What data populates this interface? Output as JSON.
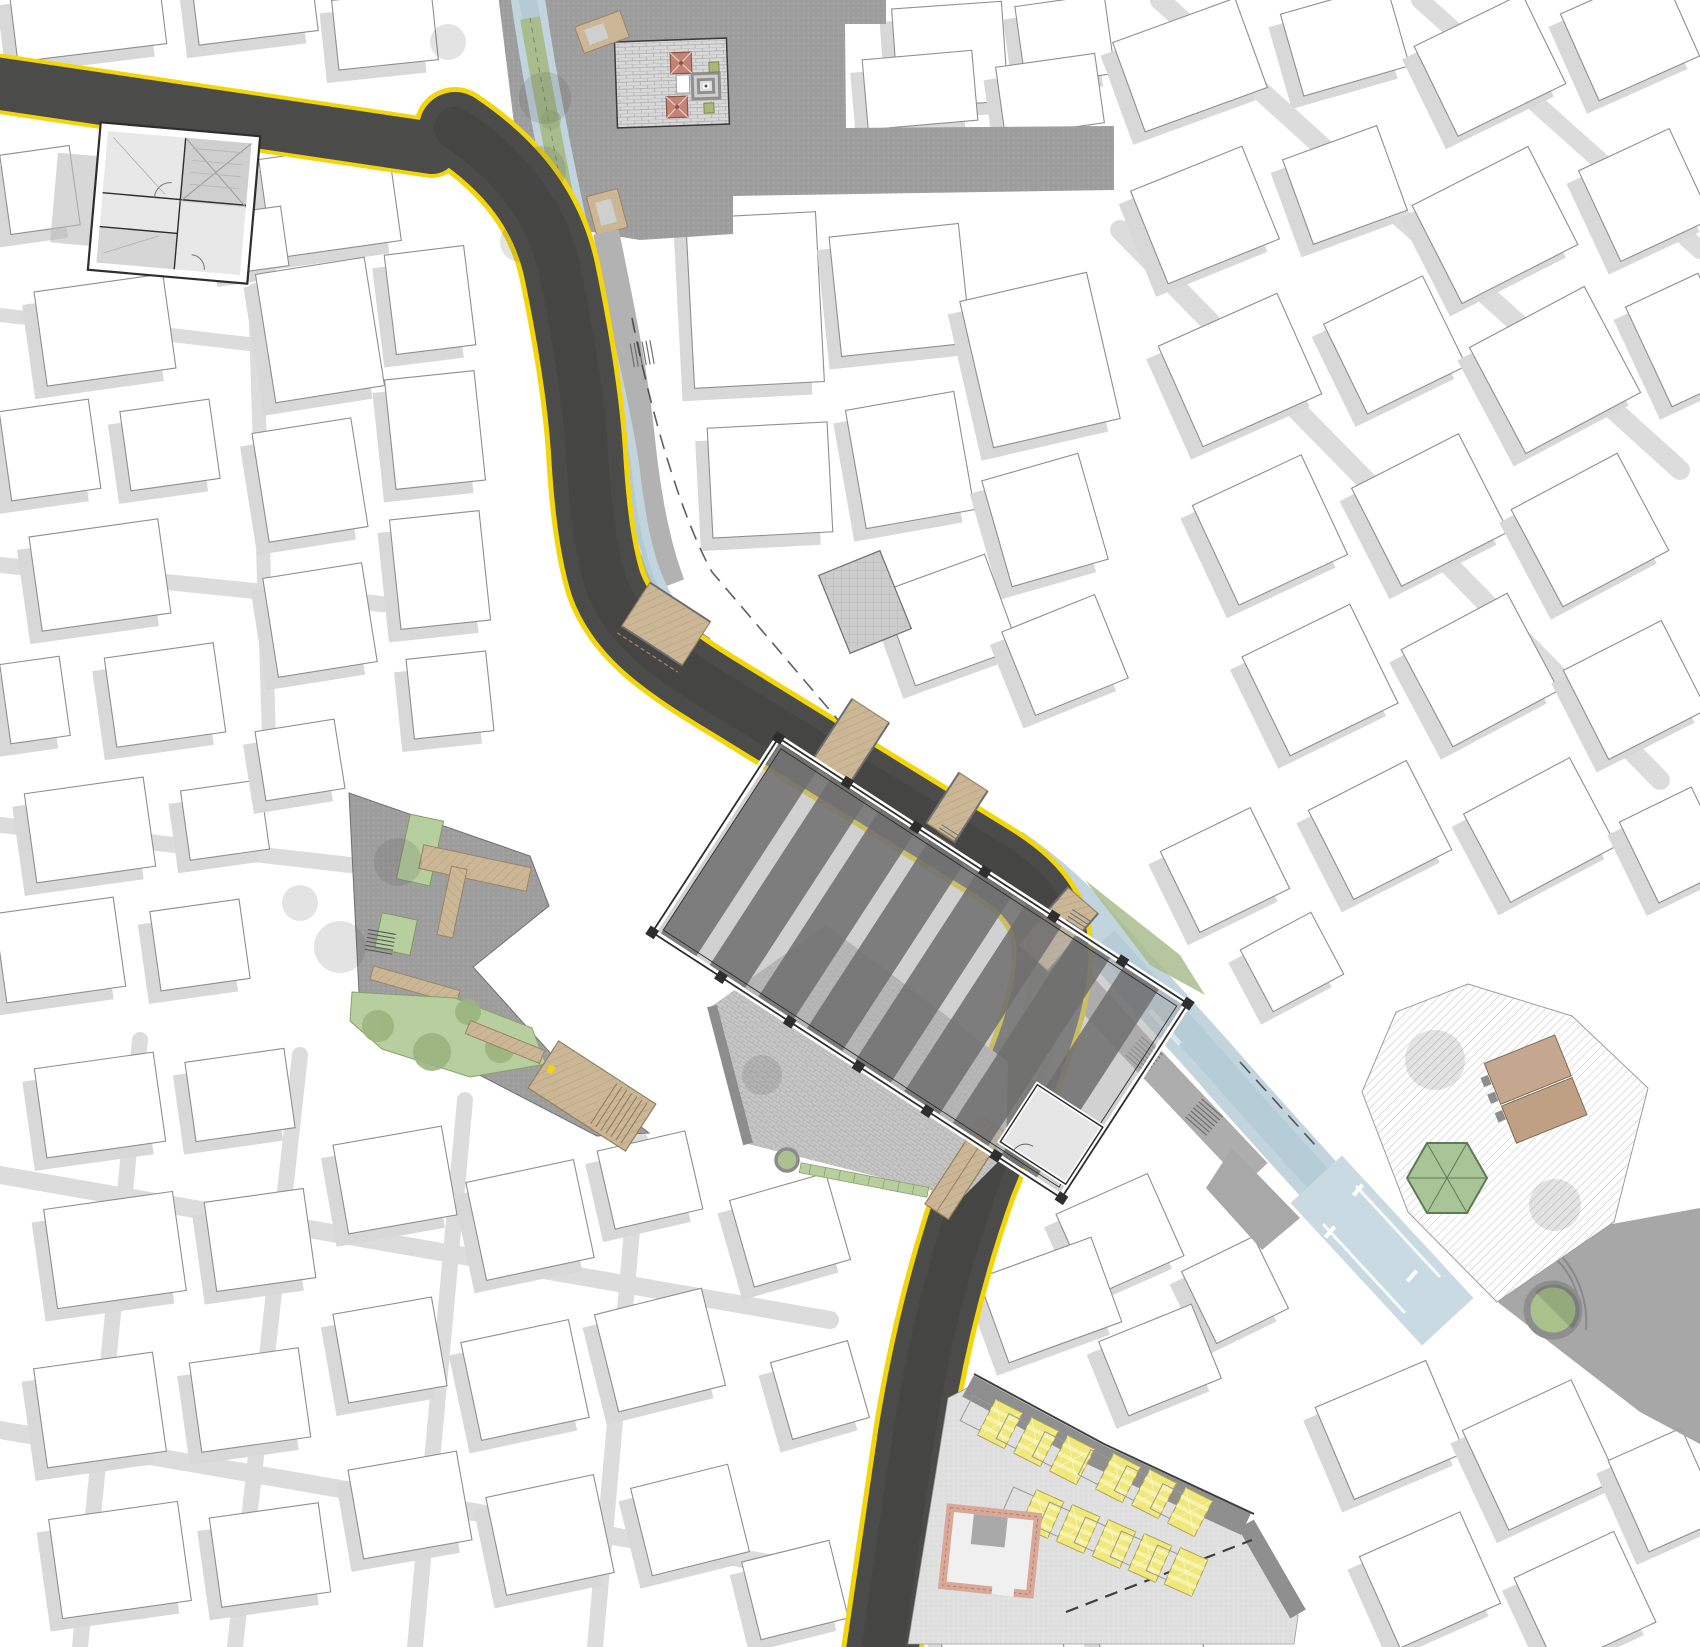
{
  "map": {
    "document_type": "architectural-site-plan",
    "orientation": "plan-view",
    "colors": {
      "background": "#ffffff",
      "building_fill": "#ffffff",
      "building_stroke": "#8f8f8f",
      "shadow": "#d8d8d8",
      "street": "#dcdcdc",
      "asphalt": "#4b4b49",
      "asphalt_dark": "#3f3f3e",
      "road_marking_yellow": "#f2d60a",
      "canal_water": "#c2d4de",
      "canal_deep": "#a9c3d0",
      "greenway": "#a9bc8d",
      "greenway_line": "#6d7c57",
      "lawn": "#b7cf9e",
      "foliage": "#93ac74",
      "tree_shadow": "rgba(80,80,80,0.16)",
      "timber": "#cbb795",
      "timber_edge": "#9b8466",
      "paving_dark": "#9e9e9e",
      "paving_light": "#e0e0e0",
      "cobble_base": "#c6c6c6",
      "brick_paving": "#d9d9d9",
      "hatch_line": "#b8b8b8",
      "stall_yellow": "#f0e87d",
      "stall_stripe": "#f8f3ab",
      "stall_edge": "#ada64f",
      "canopy_red": "#c38476",
      "canopy_red_edge": "#8d574c",
      "hexagon_green": "#a9c598",
      "hexagon_edge": "#5d7c55",
      "tan_building": "#c4a78e",
      "tan_building_edge": "#7d6a55",
      "brick_wall": "#d9a896",
      "brick_wall_dark": "#b07f6e",
      "hall_roof": "#6e6e6e",
      "hall_gap": "#ababab",
      "wall_line": "#2e2e2e",
      "stair_line": "#6f6f6f",
      "dash_line": "#2b2b2b"
    },
    "features": {
      "main_street": "curving asphalt street with yellow edge lines",
      "stream": "daylighted stream channel running beside the street into a plaza basin",
      "market_hall": "long open-air hall with striped roof bays and perimeter columns",
      "pocket_park": "triangular park with lawns, timber decks and stairs",
      "upper_plaza": "brick-paved court with fountain, two red canopies and benches",
      "east_plaza": "hatch-paved plaza with green hexagonal pavilion and round tree planter",
      "market_plaza": "light paved ground with two rows of yellow canopy stalls",
      "bridges": "timber decks crossing the stream"
    },
    "counts": {
      "red_canopies": 2,
      "yellow_market_stalls": 11,
      "timber_bridges": 4,
      "stair_flights": 5,
      "round_tree_planters": 2,
      "hexagon_pavilions": 1
    },
    "context_buildings": [
      [
        88,
        18,
        150,
        70,
        -7
      ],
      [
        255,
        8,
        120,
        60,
        -7
      ],
      [
        385,
        30,
        100,
        70,
        -6
      ],
      [
        950,
        55,
        110,
        100,
        -4
      ],
      [
        1065,
        40,
        90,
        80,
        -8
      ],
      [
        40,
        190,
        70,
        80,
        -8
      ],
      [
        330,
        200,
        130,
        100,
        -8
      ],
      [
        255,
        240,
        60,
        60,
        -8
      ],
      [
        105,
        330,
        130,
        95,
        -8
      ],
      [
        50,
        450,
        90,
        90,
        -8
      ],
      [
        170,
        445,
        90,
        80,
        -8
      ],
      [
        100,
        575,
        130,
        95,
        -8
      ],
      [
        35,
        700,
        60,
        80,
        -8
      ],
      [
        165,
        695,
        110,
        90,
        -8
      ],
      [
        90,
        830,
        120,
        90,
        -8
      ],
      [
        225,
        820,
        80,
        70,
        -8
      ],
      [
        60,
        950,
        120,
        90,
        -8
      ],
      [
        200,
        945,
        90,
        80,
        -8
      ],
      [
        320,
        330,
        110,
        130,
        -9
      ],
      [
        310,
        480,
        100,
        110,
        -9
      ],
      [
        320,
        620,
        100,
        100,
        -9
      ],
      [
        300,
        760,
        80,
        70,
        -9
      ],
      [
        430,
        300,
        80,
        100,
        -7
      ],
      [
        435,
        430,
        90,
        110,
        -6
      ],
      [
        440,
        570,
        90,
        110,
        -6
      ],
      [
        450,
        695,
        80,
        80,
        -6
      ],
      [
        780,
        80,
        120,
        80,
        -3
      ],
      [
        920,
        90,
        110,
        70,
        -5
      ],
      [
        1050,
        95,
        100,
        70,
        -8
      ],
      [
        755,
        300,
        130,
        170,
        -3
      ],
      [
        900,
        290,
        130,
        120,
        -6
      ],
      [
        1040,
        360,
        130,
        150,
        -13
      ],
      [
        770,
        480,
        120,
        110,
        -3
      ],
      [
        910,
        460,
        110,
        120,
        -10
      ],
      [
        1045,
        520,
        100,
        110,
        -16
      ],
      [
        950,
        620,
        110,
        100,
        -20
      ],
      [
        1065,
        655,
        100,
        90,
        -22
      ],
      [
        1190,
        65,
        130,
        95,
        -20
      ],
      [
        1345,
        40,
        110,
        85,
        -16
      ],
      [
        1490,
        65,
        120,
        100,
        -26
      ],
      [
        1630,
        35,
        110,
        95,
        -24
      ],
      [
        1205,
        215,
        120,
        100,
        -22
      ],
      [
        1345,
        185,
        100,
        90,
        -20
      ],
      [
        1495,
        225,
        130,
        110,
        -27
      ],
      [
        1645,
        195,
        100,
        100,
        -25
      ],
      [
        1240,
        370,
        130,
        110,
        -24
      ],
      [
        1395,
        345,
        110,
        100,
        -26
      ],
      [
        1555,
        370,
        130,
        120,
        -28
      ],
      [
        1685,
        340,
        80,
        110,
        -25
      ],
      [
        1270,
        530,
        120,
        110,
        -25
      ],
      [
        1430,
        510,
        120,
        110,
        -27
      ],
      [
        1590,
        530,
        120,
        110,
        -28
      ],
      [
        1320,
        680,
        120,
        110,
        -26
      ],
      [
        1480,
        670,
        120,
        110,
        -28
      ],
      [
        1635,
        690,
        110,
        100,
        -27
      ],
      [
        1380,
        830,
        110,
        100,
        -27
      ],
      [
        1540,
        830,
        120,
        100,
        -28
      ],
      [
        1675,
        845,
        80,
        90,
        -26
      ],
      [
        1225,
        870,
        100,
        90,
        -26
      ],
      [
        1292,
        962,
        80,
        70,
        -28
      ],
      [
        1120,
        1235,
        100,
        90,
        -24
      ],
      [
        1235,
        1290,
        80,
        80,
        -26
      ],
      [
        1390,
        1430,
        120,
        100,
        -23
      ],
      [
        1540,
        1455,
        120,
        110,
        -25
      ],
      [
        1665,
        1490,
        80,
        100,
        -24
      ],
      [
        1430,
        1580,
        110,
        100,
        -24
      ],
      [
        1585,
        1600,
        110,
        100,
        -25
      ],
      [
        100,
        1105,
        120,
        90,
        -8
      ],
      [
        240,
        1095,
        100,
        80,
        -8
      ],
      [
        115,
        1250,
        130,
        100,
        -8
      ],
      [
        260,
        1240,
        100,
        90,
        -8
      ],
      [
        395,
        1180,
        110,
        90,
        -10
      ],
      [
        530,
        1220,
        110,
        100,
        -12
      ],
      [
        650,
        1180,
        90,
        80,
        -13
      ],
      [
        100,
        1410,
        120,
        100,
        -8
      ],
      [
        250,
        1400,
        110,
        90,
        -8
      ],
      [
        390,
        1350,
        100,
        90,
        -10
      ],
      [
        525,
        1380,
        110,
        100,
        -12
      ],
      [
        660,
        1350,
        110,
        100,
        -14
      ],
      [
        120,
        1560,
        130,
        100,
        -8
      ],
      [
        270,
        1555,
        110,
        90,
        -8
      ],
      [
        410,
        1505,
        110,
        90,
        -10
      ],
      [
        550,
        1535,
        110,
        100,
        -12
      ],
      [
        690,
        1520,
        100,
        90,
        -14
      ],
      [
        790,
        1230,
        100,
        90,
        -16
      ],
      [
        820,
        1390,
        80,
        80,
        -16
      ],
      [
        795,
        1590,
        90,
        80,
        -14
      ],
      [
        1050,
        1300,
        120,
        90,
        -20
      ],
      [
        1160,
        1360,
        100,
        80,
        -22
      ],
      [
        1000,
        1630,
        120,
        60,
        -10
      ],
      [
        1150,
        1640,
        100,
        50,
        -15
      ]
    ],
    "street_strips": [
      [
        140,
        1040,
        80,
        1647,
        16
      ],
      [
        300,
        1055,
        235,
        1647,
        16
      ],
      [
        465,
        1100,
        415,
        1647,
        16
      ],
      [
        640,
        1140,
        595,
        1647,
        16
      ],
      [
        0,
        1175,
        830,
        1320,
        18
      ],
      [
        0,
        1430,
        780,
        1565,
        18
      ],
      [
        1160,
        0,
        1680,
        470,
        20
      ],
      [
        1420,
        0,
        1700,
        250,
        18
      ],
      [
        1120,
        230,
        1660,
        780,
        20
      ],
      [
        255,
        290,
        270,
        770,
        14
      ],
      [
        0,
        315,
        300,
        350,
        14
      ],
      [
        0,
        565,
        440,
        610,
        16
      ],
      [
        0,
        825,
        350,
        865,
        16
      ]
    ],
    "bank_trees": [
      [
        551,
        120
      ],
      [
        563,
        200
      ],
      [
        577,
        280
      ],
      [
        590,
        360
      ],
      [
        600,
        440
      ],
      [
        612,
        505
      ],
      [
        628,
        560
      ],
      [
        668,
        618
      ],
      [
        720,
        662
      ],
      [
        790,
        707
      ],
      [
        860,
        752
      ]
    ],
    "shade_trees": [
      [
        545,
        98,
        26
      ],
      [
        542,
        170,
        24
      ],
      [
        520,
        242,
        20
      ],
      [
        448,
        42,
        18
      ],
      [
        398,
        862,
        24
      ],
      [
        340,
        947,
        26
      ],
      [
        300,
        903,
        18
      ],
      [
        762,
        1075,
        20
      ],
      [
        1435,
        1060,
        30
      ],
      [
        1555,
        1205,
        26
      ]
    ],
    "canal_benches": [
      [
        560,
        190,
        6
      ],
      [
        575,
        264,
        8
      ],
      [
        590,
        352,
        9
      ],
      [
        604,
        434,
        10
      ],
      [
        619,
        502,
        12
      ],
      [
        700,
        644,
        33
      ]
    ],
    "market_stalls": {
      "upper_row": [
        [
          1000,
          1424
        ],
        [
          1036,
          1442
        ],
        [
          1072,
          1460
        ],
        [
          1118,
          1478
        ],
        [
          1154,
          1494
        ],
        [
          1190,
          1512
        ]
      ],
      "lower_row": [
        [
          1042,
          1514
        ],
        [
          1078,
          1529
        ],
        [
          1114,
          1544
        ],
        [
          1150,
          1558
        ],
        [
          1186,
          1572
        ]
      ],
      "angle_upper": 27,
      "angle_lower": 24
    }
  }
}
